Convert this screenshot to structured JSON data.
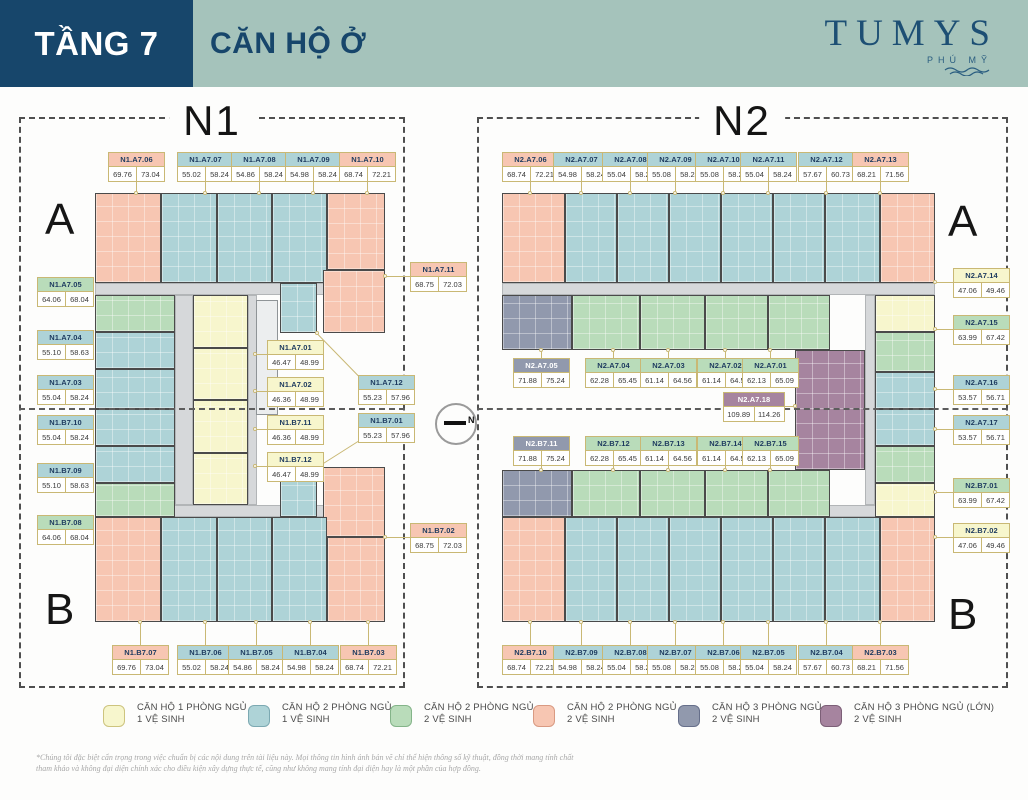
{
  "header": {
    "floor_label": "TẦNG 7",
    "title": "CĂN HỘ Ở",
    "brand": "TUMYS",
    "brand_sub": "PHÚ MỸ"
  },
  "compass": {
    "label": "N"
  },
  "colors": {
    "navy": "#17466b",
    "sage": "#a5c3bb",
    "label_border": "#c9b874",
    "corridor": "#d6d8da",
    "wall": "#4a4a4a"
  },
  "unit_types": {
    "y": {
      "fill": "#f7f6cd",
      "border": "#cdc47e",
      "text": "#1d3a5f",
      "legend_line1": "CĂN HỘ 1 PHÒNG NGỦ",
      "legend_line2": "1 VỆ SINH"
    },
    "b": {
      "fill": "#aed3d7",
      "border": "#7ca9b2",
      "text": "#1d3a5f",
      "legend_line1": "CĂN HỘ 2 PHÒNG NGỦ",
      "legend_line2": "1 VỆ SINH"
    },
    "g": {
      "fill": "#b9dcba",
      "border": "#84b489",
      "text": "#1d3a5f",
      "legend_line1": "CĂN HỘ 2 PHÒNG NGỦ",
      "legend_line2": "2 VỆ SINH"
    },
    "s": {
      "fill": "#f7c6b2",
      "border": "#d99a82",
      "text": "#1d3a5f",
      "legend_line1": "CĂN HỘ 2 PHÒNG NGỦ",
      "legend_line2": "2 VỆ SINH"
    },
    "n": {
      "fill": "#9199ad",
      "border": "#666f8a",
      "text": "#ffffff",
      "legend_line1": "CĂN HỘ 3 PHÒNG NGỦ",
      "legend_line2": "2 VỆ SINH"
    },
    "m": {
      "fill": "#a6849f",
      "border": "#7c5f77",
      "text": "#ffffff",
      "legend_line1": "CĂN HỘ 3 PHÒNG NGỦ (LỚN)",
      "legend_line2": "2 VỆ SINH"
    }
  },
  "legend_order": [
    "y",
    "b",
    "g",
    "s",
    "n",
    "m"
  ],
  "plans": [
    {
      "name": "N1",
      "wing_top": "A",
      "wing_bottom": "B",
      "units": [
        {
          "code": "N1.A7.06",
          "area1": "69.76",
          "area2": "73.04",
          "type": "s"
        },
        {
          "code": "N1.A7.07",
          "area1": "55.02",
          "area2": "58.24",
          "type": "b"
        },
        {
          "code": "N1.A7.08",
          "area1": "54.86",
          "area2": "58.24",
          "type": "b"
        },
        {
          "code": "N1.A7.09",
          "area1": "54.98",
          "area2": "58.24",
          "type": "b"
        },
        {
          "code": "N1.A7.10",
          "area1": "68.74",
          "area2": "72.21",
          "type": "s"
        },
        {
          "code": "N1.A7.11",
          "area1": "68.75",
          "area2": "72.03",
          "type": "s"
        },
        {
          "code": "N1.A7.05",
          "area1": "64.06",
          "area2": "68.04",
          "type": "g"
        },
        {
          "code": "N1.A7.04",
          "area1": "55.10",
          "area2": "58.63",
          "type": "b"
        },
        {
          "code": "N1.A7.03",
          "area1": "55.04",
          "area2": "58.24",
          "type": "b"
        },
        {
          "code": "N1.B7.10",
          "area1": "55.04",
          "area2": "58.24",
          "type": "b"
        },
        {
          "code": "N1.B7.09",
          "area1": "55.10",
          "area2": "58.63",
          "type": "b"
        },
        {
          "code": "N1.B7.08",
          "area1": "64.06",
          "area2": "68.04",
          "type": "g"
        },
        {
          "code": "N1.A7.01",
          "area1": "46.47",
          "area2": "48.99",
          "type": "y"
        },
        {
          "code": "N1.A7.02",
          "area1": "46.36",
          "area2": "48.99",
          "type": "y"
        },
        {
          "code": "N1.A7.12",
          "area1": "55.23",
          "area2": "57.96",
          "type": "b"
        },
        {
          "code": "N1.B7.11",
          "area1": "46.36",
          "area2": "48.99",
          "type": "y"
        },
        {
          "code": "N1.B7.01",
          "area1": "55.23",
          "area2": "57.96",
          "type": "b"
        },
        {
          "code": "N1.B7.12",
          "area1": "46.47",
          "area2": "48.99",
          "type": "y"
        },
        {
          "code": "N1.B7.02",
          "area1": "68.75",
          "area2": "72.03",
          "type": "s"
        },
        {
          "code": "N1.B7.07",
          "area1": "69.76",
          "area2": "73.04",
          "type": "s"
        },
        {
          "code": "N1.B7.06",
          "area1": "55.02",
          "area2": "58.24",
          "type": "b"
        },
        {
          "code": "N1.B7.05",
          "area1": "54.86",
          "area2": "58.24",
          "type": "b"
        },
        {
          "code": "N1.B7.04",
          "area1": "54.98",
          "area2": "58.24",
          "type": "b"
        },
        {
          "code": "N1.B7.03",
          "area1": "68.74",
          "area2": "72.21",
          "type": "s"
        }
      ]
    },
    {
      "name": "N2",
      "wing_top": "A",
      "wing_bottom": "B",
      "units": [
        {
          "code": "N2.A7.06",
          "area1": "68.74",
          "area2": "72.21",
          "type": "s"
        },
        {
          "code": "N2.A7.07",
          "area1": "54.98",
          "area2": "58.24",
          "type": "b"
        },
        {
          "code": "N2.A7.08",
          "area1": "55.04",
          "area2": "58.24",
          "type": "b"
        },
        {
          "code": "N2.A7.09",
          "area1": "55.08",
          "area2": "58.24",
          "type": "b"
        },
        {
          "code": "N2.A7.10",
          "area1": "55.08",
          "area2": "58.24",
          "type": "b"
        },
        {
          "code": "N2.A7.11",
          "area1": "55.04",
          "area2": "58.24",
          "type": "b"
        },
        {
          "code": "N2.A7.12",
          "area1": "57.67",
          "area2": "60.73",
          "type": "b"
        },
        {
          "code": "N2.A7.13",
          "area1": "68.21",
          "area2": "71.56",
          "type": "s"
        },
        {
          "code": "N2.A7.14",
          "area1": "47.06",
          "area2": "49.46",
          "type": "y"
        },
        {
          "code": "N2.A7.15",
          "area1": "63.99",
          "area2": "67.42",
          "type": "g"
        },
        {
          "code": "N2.A7.16",
          "area1": "53.57",
          "area2": "56.71",
          "type": "b"
        },
        {
          "code": "N2.A7.17",
          "area1": "53.57",
          "area2": "56.71",
          "type": "b"
        },
        {
          "code": "N2.B7.01",
          "area1": "63.99",
          "area2": "67.42",
          "type": "g"
        },
        {
          "code": "N2.B7.02",
          "area1": "47.06",
          "area2": "49.46",
          "type": "y"
        },
        {
          "code": "N2.A7.05",
          "area1": "71.88",
          "area2": "75.24",
          "type": "n"
        },
        {
          "code": "N2.A7.04",
          "area1": "62.28",
          "area2": "65.45",
          "type": "g"
        },
        {
          "code": "N2.A7.03",
          "area1": "61.14",
          "area2": "64.56",
          "type": "g"
        },
        {
          "code": "N2.A7.02",
          "area1": "61.14",
          "area2": "64.56",
          "type": "g"
        },
        {
          "code": "N2.A7.01",
          "area1": "62.13",
          "area2": "65.09",
          "type": "g"
        },
        {
          "code": "N2.A7.18",
          "area1": "109.89",
          "area2": "114.26",
          "type": "m"
        },
        {
          "code": "N2.B7.11",
          "area1": "71.88",
          "area2": "75.24",
          "type": "n"
        },
        {
          "code": "N2.B7.12",
          "area1": "62.28",
          "area2": "65.45",
          "type": "g"
        },
        {
          "code": "N2.B7.13",
          "area1": "61.14",
          "area2": "64.56",
          "type": "g"
        },
        {
          "code": "N2.B7.14",
          "area1": "61.14",
          "area2": "64.56",
          "type": "g"
        },
        {
          "code": "N2.B7.15",
          "area1": "62.13",
          "area2": "65.09",
          "type": "g"
        },
        {
          "code": "N2.B7.10",
          "area1": "68.74",
          "area2": "72.21",
          "type": "s"
        },
        {
          "code": "N2.B7.09",
          "area1": "54.98",
          "area2": "58.24",
          "type": "b"
        },
        {
          "code": "N2.B7.08",
          "area1": "55.04",
          "area2": "58.24",
          "type": "b"
        },
        {
          "code": "N2.B7.07",
          "area1": "55.08",
          "area2": "58.24",
          "type": "b"
        },
        {
          "code": "N2.B7.06",
          "area1": "55.08",
          "area2": "58.24",
          "type": "b"
        },
        {
          "code": "N2.B7.05",
          "area1": "55.04",
          "area2": "58.24",
          "type": "b"
        },
        {
          "code": "N2.B7.04",
          "area1": "57.67",
          "area2": "60.73",
          "type": "b"
        },
        {
          "code": "N2.B7.03",
          "area1": "68.21",
          "area2": "71.56",
          "type": "s"
        }
      ]
    }
  ],
  "disclaimer": [
    "*Chúng tôi đặc biệt cẩn trọng trong việc chuẩn bị các nội dung trên tài liệu này. Mọi thông tin hình ảnh bản vẽ chỉ thể hiện thông số kỹ thuật, đồng thời mang tính chất",
    "tham khảo và không đại diện chính xác cho điều kiện xây dựng thực tế, cũng như không mang tính đại diện hay là một phần của hợp đồng."
  ]
}
